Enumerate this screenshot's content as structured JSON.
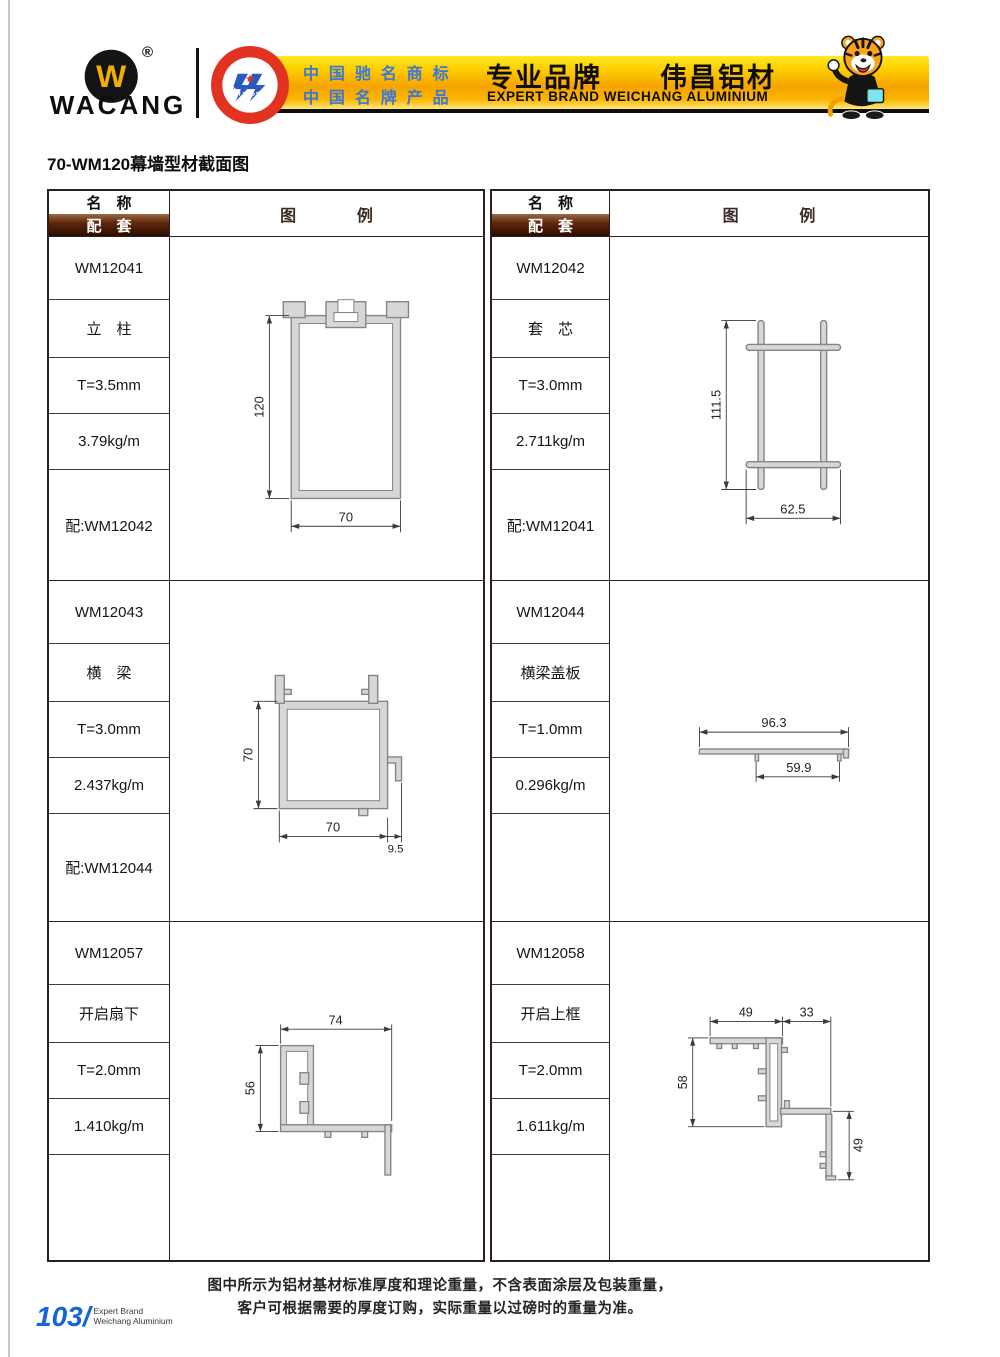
{
  "header": {
    "brand": "WACANG",
    "reg_mark": "®",
    "logo_glyph": "W",
    "badge_top": "中国名牌",
    "badge_bottom": "CHINA TOP BRAND",
    "banner": {
      "line1": "中国驰名商标",
      "line2": "中国名牌产品",
      "title": "专业品牌　　伟昌铝材",
      "subtitle": "EXPERT BRAND WEICHANG ALUMINIUM"
    }
  },
  "page_title": "70-WM120幕墙型材截面图",
  "table_header": {
    "name": "名　称",
    "match": "配　套",
    "legend": "图　例"
  },
  "products": [
    {
      "code": "WM12041",
      "name": "立　柱",
      "thickness": "T=3.5mm",
      "weight": "3.79kg/m",
      "match": "配:WM12042",
      "dims": {
        "h": "120",
        "w": "70"
      }
    },
    {
      "code": "WM12042",
      "name": "套　芯",
      "thickness": "T=3.0mm",
      "weight": "2.711kg/m",
      "match": "配:WM12041",
      "dims": {
        "h": "111.5",
        "w": "62.5"
      }
    },
    {
      "code": "WM12043",
      "name": "横　梁",
      "thickness": "T=3.0mm",
      "weight": "2.437kg/m",
      "match": "配:WM12044",
      "dims": {
        "h": "70",
        "w": "70",
        "ext": "9.5"
      }
    },
    {
      "code": "WM12044",
      "name": "横梁盖板",
      "thickness": "T=1.0mm",
      "weight": "0.296kg/m",
      "match": "",
      "dims": {
        "overall": "96.3",
        "inner": "59.9"
      }
    },
    {
      "code": "WM12057",
      "name": "开启扇下",
      "thickness": "T=2.0mm",
      "weight": "1.410kg/m",
      "match": "",
      "dims": {
        "w": "74",
        "h": "56"
      }
    },
    {
      "code": "WM12058",
      "name": "开启上框",
      "thickness": "T=2.0mm",
      "weight": "1.611kg/m",
      "match": "",
      "dims": {
        "tl": "49",
        "tr": "33",
        "left": "58",
        "right": "49"
      }
    }
  ],
  "footer": {
    "note1": "图中所示为铝材基材标准厚度和理论重量，不含表面涂层及包装重量，",
    "note2": "客户可根据需要的厚度订购，实际重量以过磅时的重量为准。",
    "page_number": "103/",
    "page_brand_line1": "Expert Brand",
    "page_brand_line2": "Weichang Aluminium"
  },
  "icons": {
    "logo": "wacang-w-logo",
    "badge": "china-top-brand-badge",
    "mascot": "tiger-mascot"
  },
  "colors": {
    "banner_gold": "#f5a300",
    "banner_yellow": "#ffe400",
    "bar_brown": "#3a1505",
    "accent_blue": "#3b77d9",
    "page_number_blue": "#1565d8"
  }
}
